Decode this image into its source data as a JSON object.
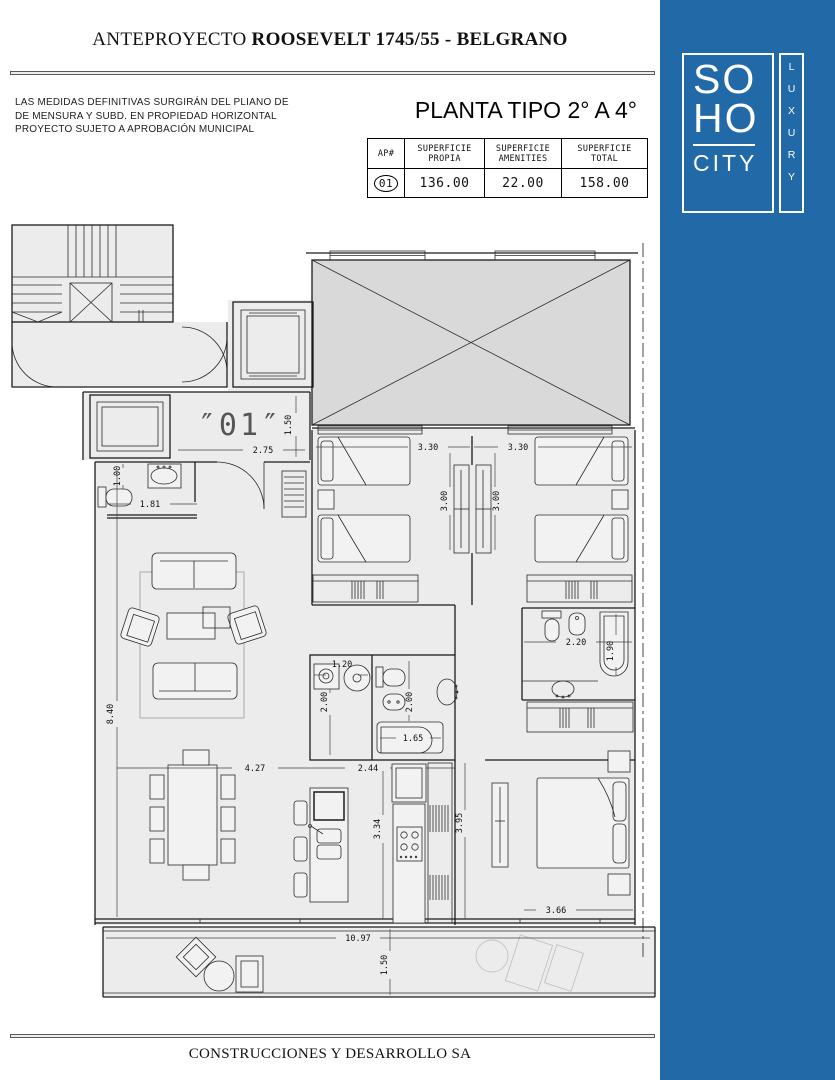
{
  "colors": {
    "brand_blue": "#2169a7",
    "plan_fill": "#ececec",
    "patio_fill": "#d9d9d9"
  },
  "header": {
    "title_prefix": "ANTEPROYECTO",
    "title_main": "ROOSEVELT 1745/55 - BELGRANO"
  },
  "disclaimer": {
    "line1": "LAS MEDIDAS DEFINITIVAS SURGIRÁN DEL PLIANO DE",
    "line2": "DE MENSURA Y SUBD. EN PROPIEDAD HORIZONTAL",
    "line3": "PROYECTO SUJETO A APROBACIÓN MUNICIPAL"
  },
  "plan_title": "PLANTA TIPO 2° A 4°",
  "table": {
    "col_ap": "AP#",
    "cols": [
      {
        "l1": "SUPERFICIE",
        "l2": "PROPIA"
      },
      {
        "l1": "SUPERFICIE",
        "l2": "AMENITIES"
      },
      {
        "l1": "SUPERFICIE",
        "l2": "TOTAL"
      }
    ],
    "row": {
      "ap": "01",
      "propia": "136.00",
      "amenities": "22.00",
      "total": "158.00"
    }
  },
  "logo": {
    "line1": "SO",
    "line2": "HO",
    "line3": "CITY",
    "vertical": "LUXURY"
  },
  "plan": {
    "unit_label": "″01″",
    "dims": {
      "hall_w": "2.75",
      "hall_d": "1.50",
      "wc_d": "1.00",
      "wc_w": "1.81",
      "bed1_w": "3.30",
      "bed2_w": "3.30",
      "bed1_d": "3.00",
      "bed2_d": "3.00",
      "bath2_w": "2.20",
      "bath2_tub": "1.90",
      "laundry_w": "1.20",
      "laundry_d": "2.00",
      "bath1_d": "2.00",
      "bath1_tub": "1.65",
      "living_d": "8.40",
      "dining_w": "4.27",
      "kitchen_w": "2.44",
      "kitchen_d": "3.34",
      "master_d": "3.95",
      "master_w": "3.66",
      "balcony_w": "10.97",
      "balcony_d": "1.50"
    }
  },
  "footer": "CONSTRUCCIONES Y DESARROLLO SA"
}
